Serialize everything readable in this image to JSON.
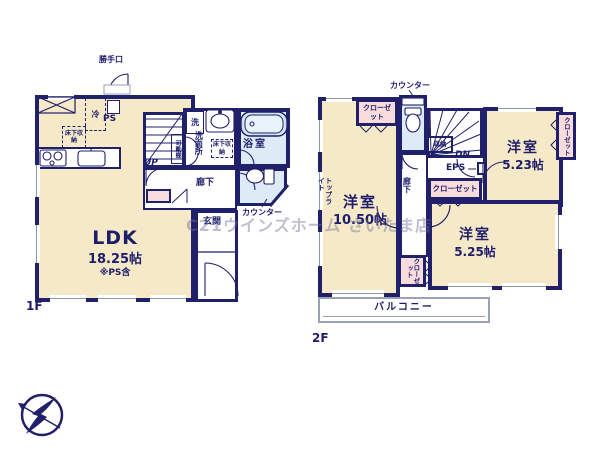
{
  "watermark": "C21ウインズホーム さいたま店",
  "colors": {
    "wall": "#20206b",
    "room_fill": "#f6e9c8",
    "wet_fill": "#dcebf5",
    "closet_fill": "#f8dcdc",
    "watermark": "#6c7294"
  },
  "floor1": {
    "label": "1F",
    "ldk": {
      "name": "LDK",
      "area": "18.25帖",
      "note": "※PS含"
    },
    "labels": {
      "backdoor": "勝手口",
      "fridge": "冷",
      "ps": "PS",
      "underfloor_kitchen": "床下収納",
      "underfloor_wash": "床下収納",
      "movable_shelf": "可動棚",
      "washer": "洗",
      "washroom": "洗面所",
      "bathroom": "浴室",
      "hallway": "廊下",
      "counter": "カウンター",
      "entrance": "玄関",
      "up": "UP"
    }
  },
  "floor2": {
    "label": "2F",
    "rooms": {
      "bedroom_large": {
        "name": "洋室",
        "area": "10.50帖"
      },
      "bedroom_east": {
        "name": "洋室",
        "area": "5.23帖"
      },
      "bedroom_south": {
        "name": "洋室",
        "area": "5.25帖"
      }
    },
    "labels": {
      "counter": "カウンター",
      "closet_nw": "クローゼット",
      "closet_e": "クローゼット",
      "closet_mid": "クローゼット",
      "closet_s": "クローゼット",
      "storage": "収納",
      "dn": "DN",
      "eps": "EPS",
      "hallway": "廊下",
      "toplight": "トップライト",
      "balcony": "バルコニー"
    }
  }
}
